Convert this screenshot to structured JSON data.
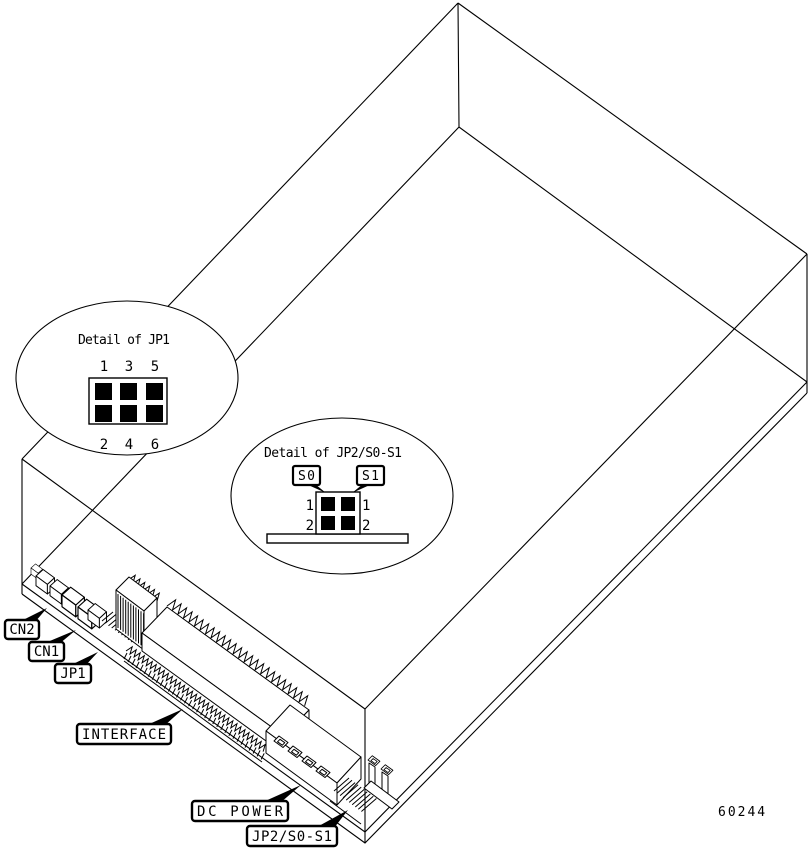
{
  "figure": {
    "background_color": "#ffffff",
    "line_color": "#000000",
    "figure_number": "60244",
    "callouts": {
      "cn2": "CN2",
      "cn1": "CN1",
      "jp1": "JP1",
      "interface": "INTERFACE",
      "dc_power": "DC POWER",
      "jp2_s0_s1": "JP2/S0-S1"
    },
    "detail_jp1": {
      "title": "Detail of JP1",
      "top_pin_numbers": [
        "1",
        "3",
        "5"
      ],
      "bottom_pin_numbers": [
        "2",
        "4",
        "6"
      ]
    },
    "detail_jp2": {
      "title": "Detail of JP2/S0-S1",
      "switch_tags": [
        "S0",
        "S1"
      ],
      "left_pin_numbers": [
        "1",
        "2"
      ],
      "right_pin_numbers": [
        "1",
        "2"
      ]
    }
  }
}
